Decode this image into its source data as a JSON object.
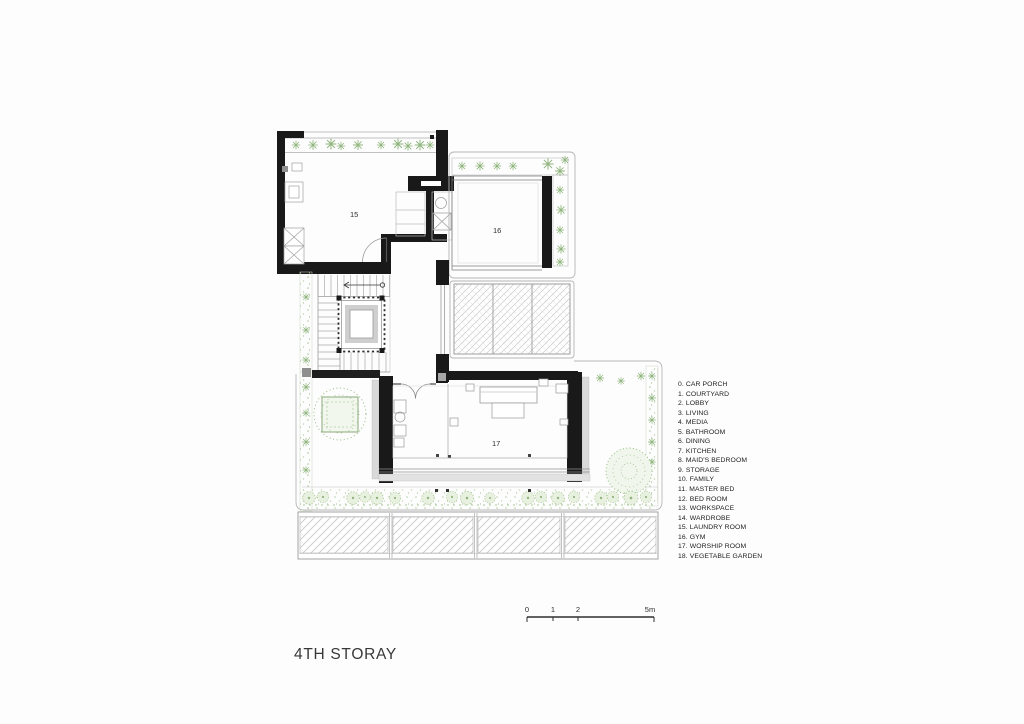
{
  "title": "4TH STORAY",
  "rooms": {
    "r15": "15",
    "r16": "16",
    "r17": "17"
  },
  "legend": {
    "items": [
      "0. CAR PORCH",
      "1. COURTYARD",
      "2. LOBBY",
      "3. LIVING",
      "4. MEDIA",
      "5. BATHROOM",
      "6. DINING",
      "7. KITCHEN",
      "8. MAID'S BEDROOM",
      "9. STORAGE",
      "10. FAMILY",
      "11. MASTER BED",
      "12. BED ROOM",
      "13. WORKSPACE",
      "14. WARDROBE",
      "15. LAUNDRY ROOM",
      "16. GYM",
      "17. WORSHIP ROOM",
      "18. VEGETABLE GARDEN"
    ]
  },
  "scale": {
    "t0": "0",
    "t1": "1",
    "t2": "2",
    "t5": "5m"
  },
  "colors": {
    "wall_black": "#191919",
    "accent_green": "#9cbd8b",
    "hatch_gray": "#c6c6c6"
  }
}
